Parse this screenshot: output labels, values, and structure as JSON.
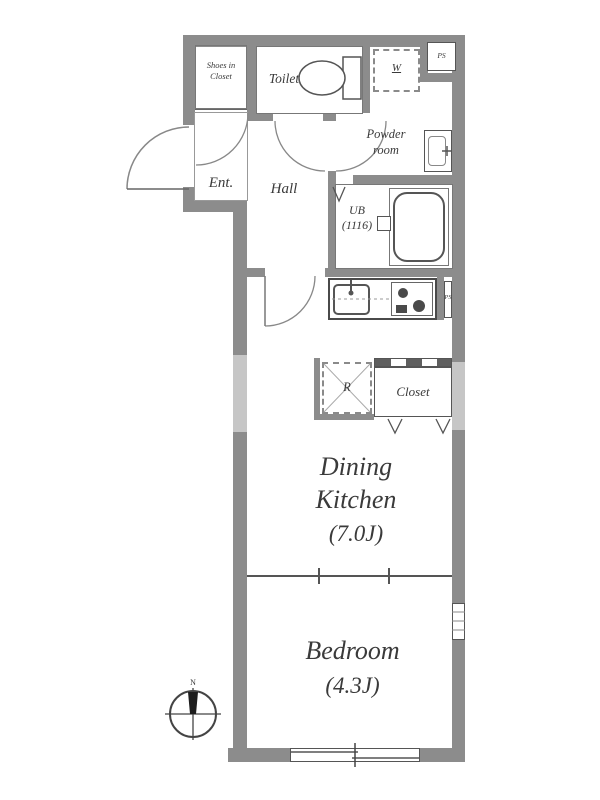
{
  "title": "1DK apartment floor plan",
  "rooms": {
    "shoes_closet": {
      "line1": "Shoes in",
      "line2": "Closet"
    },
    "toilet": {
      "label": "Toilet"
    },
    "washer": {
      "label": "W"
    },
    "ps_top": {
      "label": "PS"
    },
    "powder": {
      "line1": "Powder",
      "line2": "room"
    },
    "ent": {
      "label": "Ent."
    },
    "hall": {
      "label": "Hall"
    },
    "ub": {
      "line1": "UB",
      "line2": "(1116)"
    },
    "ps_kitchen": {
      "label": "PS"
    },
    "fridge": {
      "label": "R"
    },
    "closet": {
      "label": "Closet"
    },
    "dining_kitchen": {
      "line1": "Dining",
      "line2": "Kitchen",
      "size": "(7.0J)"
    },
    "bedroom": {
      "label": "Bedroom",
      "size": "(4.3J)"
    }
  },
  "compass": {
    "north_label": "N"
  },
  "colors": {
    "wall": "#8c8c8c",
    "line": "#555555",
    "text": "#3a3a3a",
    "window_light": "#c6c6c6",
    "background": "#ffffff"
  }
}
